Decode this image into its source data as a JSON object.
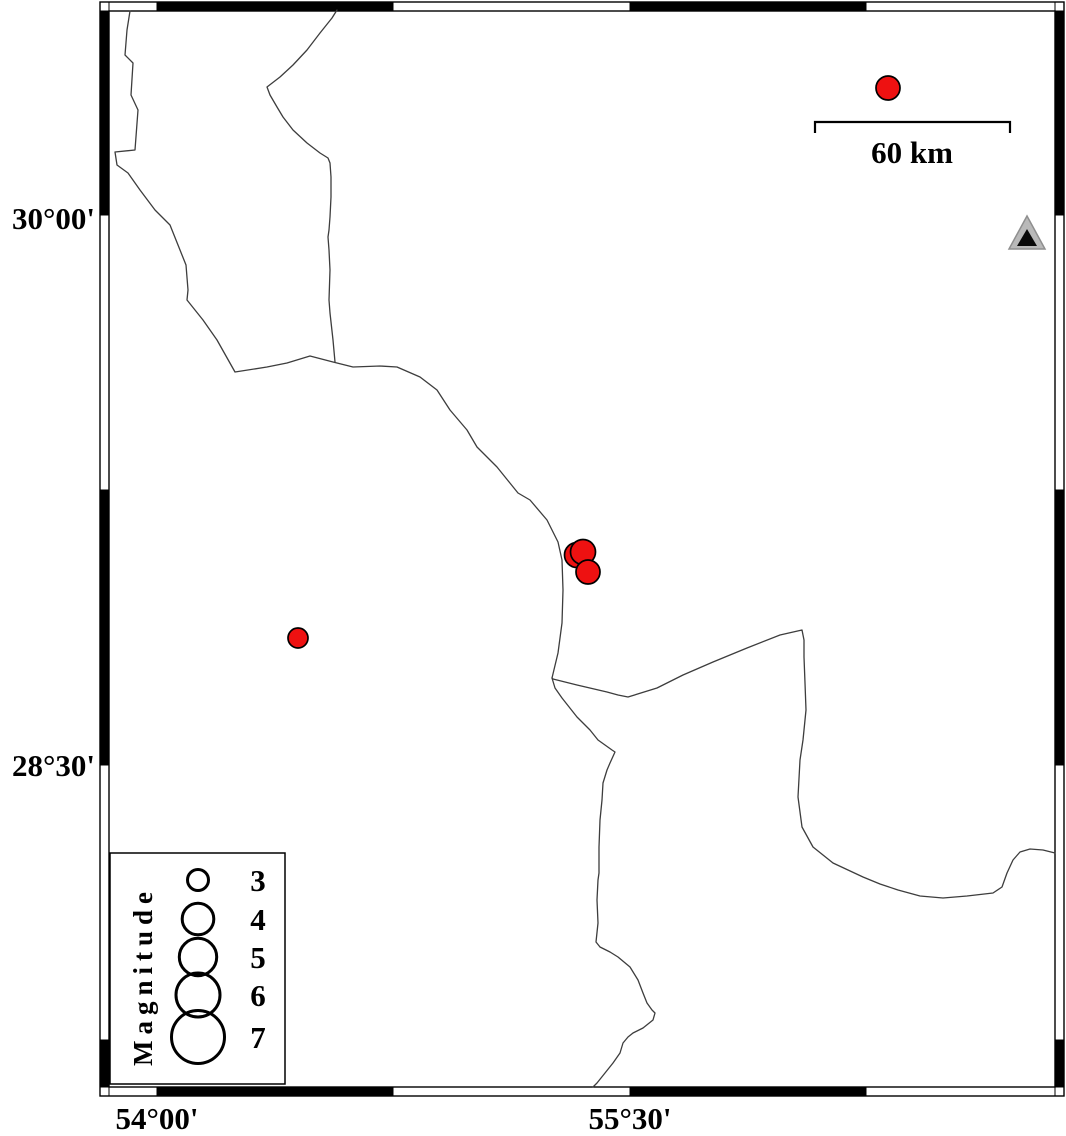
{
  "map_title": "Seismicity map with magnitude legend",
  "colors": {
    "background": "#ffffff",
    "frame_black": "#000000",
    "frame_white": "#ffffff",
    "boundary_line": "#3d3d3d",
    "epicenter_fill": "#ee1111",
    "epicenter_stroke": "#000000",
    "station_fill": "#b9b9b9",
    "station_stroke": "#8f8f8f",
    "station_inner": "#0a0a0a"
  },
  "frame": {
    "outer": {
      "x": 100,
      "y": 2,
      "w": 964,
      "h": 1094
    },
    "inner": {
      "x": 109,
      "y": 11,
      "w": 946,
      "h": 1076
    },
    "strip": 9,
    "h_cells": [
      {
        "x1": 109,
        "x2": 157,
        "fill": "#ffffff"
      },
      {
        "x1": 157,
        "x2": 393,
        "fill": "#000000"
      },
      {
        "x1": 393,
        "x2": 630,
        "fill": "#ffffff"
      },
      {
        "x1": 630,
        "x2": 866,
        "fill": "#000000"
      },
      {
        "x1": 866,
        "x2": 1055,
        "fill": "#ffffff"
      }
    ],
    "v_cells": [
      {
        "y1": 11,
        "y2": 215,
        "fill": "#000000"
      },
      {
        "y1": 215,
        "y2": 490,
        "fill": "#ffffff"
      },
      {
        "y1": 490,
        "y2": 765,
        "fill": "#000000"
      },
      {
        "y1": 765,
        "y2": 1040,
        "fill": "#ffffff"
      },
      {
        "y1": 1040,
        "y2": 1087,
        "fill": "#000000"
      }
    ]
  },
  "axes": {
    "left_labels": [
      {
        "text": "30°00'",
        "y": 229
      },
      {
        "text": "28°30'",
        "y": 776
      }
    ],
    "bottom_labels": [
      {
        "text": "54°00'",
        "x": 157,
        "y": 1129
      },
      {
        "text": "55°30'",
        "x": 630,
        "y": 1129
      }
    ]
  },
  "scale_bar": {
    "label": "60 km",
    "x1": 815,
    "x2": 1010,
    "y": 122,
    "tick_drop": 11,
    "label_x": 912,
    "label_y": 163
  },
  "legend": {
    "title": "Magnitude",
    "box": {
      "x": 110,
      "y": 853,
      "w": 175,
      "h": 231
    },
    "circles_x": 198,
    "numbers_x": 258,
    "rows": [
      {
        "magnitude": "3",
        "r": 10.5,
        "cy": 880
      },
      {
        "magnitude": "4",
        "r": 15.8,
        "cy": 919
      },
      {
        "magnitude": "5",
        "r": 18.7,
        "cy": 957
      },
      {
        "magnitude": "6",
        "r": 22.0,
        "cy": 995
      },
      {
        "magnitude": "7",
        "r": 26.5,
        "cy": 1037
      }
    ]
  },
  "station": {
    "symbol": "triangle",
    "x": 1027,
    "y": 233,
    "outer_points": "1027,216 1009,249 1045,249",
    "inner_points": "1027,229 1017,246 1037,246",
    "approx_lon": "56.76",
    "approx_lat": "29.95"
  },
  "events": [
    {
      "x": 888,
      "y": 88,
      "r": 12.0,
      "approx_lon": "56.32",
      "approx_lat": "30.35"
    },
    {
      "x": 577,
      "y": 555,
      "r": 12.5,
      "approx_lon": "55.33",
      "approx_lat": "29.07"
    },
    {
      "x": 583,
      "y": 552,
      "r": 12.5,
      "approx_lon": "55.35",
      "approx_lat": "29.08"
    },
    {
      "x": 588,
      "y": 572,
      "r": 12.0,
      "approx_lon": "55.37",
      "approx_lat": "29.03"
    },
    {
      "x": 298,
      "y": 638,
      "r": 10.0,
      "approx_lon": "54.45",
      "approx_lat": "28.85"
    }
  ],
  "map_lines": {
    "west_boundary": [
      130,
      11,
      127,
      30,
      125,
      55,
      133,
      63,
      131,
      95,
      138,
      110,
      135,
      150,
      115,
      152,
      117,
      165,
      128,
      173,
      140,
      190,
      155,
      210,
      170,
      225,
      178,
      245,
      186,
      265,
      188,
      290,
      187,
      300,
      203,
      320,
      217,
      340,
      235,
      372,
      267,
      367,
      287,
      363,
      310,
      356,
      333,
      362,
      353,
      367,
      380,
      366,
      397,
      367,
      420,
      377,
      437,
      390,
      450,
      410,
      467,
      430,
      477,
      447,
      497,
      467,
      518,
      493,
      530,
      500,
      547,
      520,
      558,
      542,
      562,
      560,
      563,
      590,
      562,
      623,
      558,
      653,
      552,
      678,
      555,
      688,
      562,
      698,
      577,
      717,
      590,
      730,
      598,
      740,
      612,
      750,
      615,
      752,
      610,
      763,
      607,
      770,
      603,
      783,
      602,
      800,
      600,
      820,
      599,
      847,
      599,
      873,
      598,
      880,
      597,
      900,
      598,
      923,
      596,
      942,
      600,
      947,
      610,
      952,
      618,
      957,
      630,
      967,
      638,
      980,
      643,
      993,
      647,
      1003,
      652,
      1010,
      655,
      1013,
      653,
      1020,
      643,
      1028,
      633,
      1033,
      628,
      1037,
      623,
      1043,
      620,
      1053,
      613,
      1063,
      605,
      1073,
      597,
      1083,
      593,
      1087
    ],
    "north_boundary": [
      337,
      10,
      332,
      18,
      320,
      33,
      307,
      50,
      293,
      65,
      280,
      77,
      267,
      87,
      270,
      95,
      277,
      107,
      283,
      117,
      293,
      130,
      307,
      143,
      320,
      153,
      328,
      158,
      330,
      163,
      331,
      177,
      331,
      197,
      330,
      217,
      329,
      230,
      328,
      237,
      329,
      250,
      330,
      270,
      329,
      300,
      330,
      313,
      333,
      340,
      335,
      362
    ],
    "east_boundary": [
      552,
      678,
      553,
      679,
      577,
      685,
      607,
      692,
      618,
      695,
      628,
      697,
      657,
      688,
      683,
      675,
      713,
      662,
      747,
      648,
      780,
      635,
      802,
      630,
      804,
      640,
      804,
      657,
      805,
      683,
      806,
      710,
      803,
      740,
      800,
      760,
      798,
      797,
      802,
      827,
      813,
      847,
      833,
      863,
      863,
      877,
      880,
      884,
      898,
      890,
      920,
      896,
      943,
      898,
      967,
      896,
      993,
      893,
      1002,
      887,
      1007,
      873,
      1013,
      860,
      1020,
      852,
      1030,
      849,
      1043,
      850,
      1055,
      853
    ]
  }
}
